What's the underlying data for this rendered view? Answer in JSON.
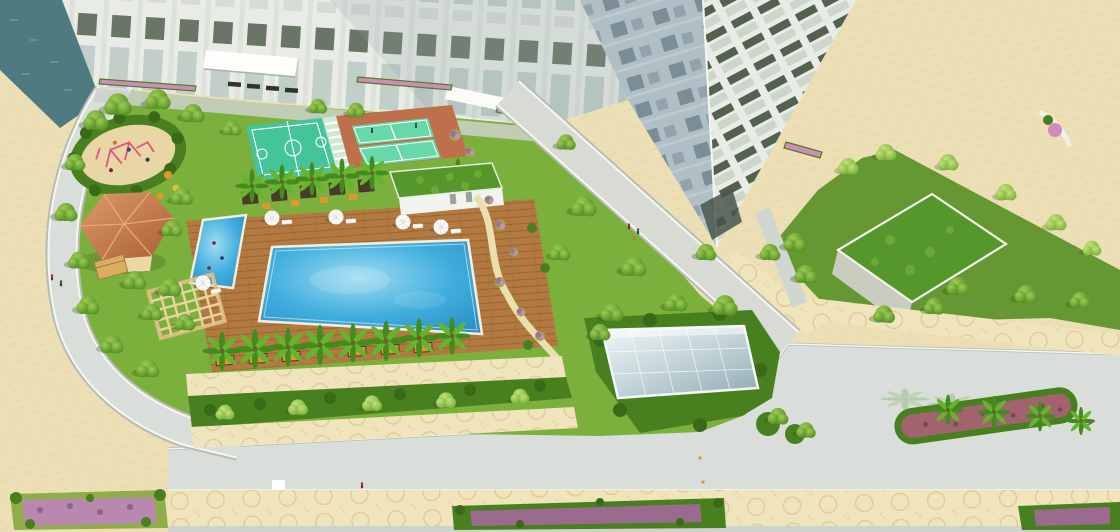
{
  "scene": {
    "type": "aerial-3d-architectural-render-of-residential-complex",
    "elements": {
      "building": "white high-rise tower with podium and entrance canopy",
      "pools": [
        "main swimming pool",
        "children's pool"
      ],
      "courts": [
        "basketball court",
        "badminton courts"
      ],
      "playground": "oval sand playground with pink play equipment",
      "pavilion": "terracotta-roof garden pavilion",
      "pergola": "timber pergola lounge",
      "pool_house": "white pool house with green living roof",
      "glass_canopy": "glass skylight canopy over hedge garden",
      "green_roof_structure": "green-roof garden structure on east lawn",
      "roads": [
        "internal loop road",
        "main boulevard with sidewalks"
      ],
      "median": "palm median island with red groundcover"
    },
    "counts": {
      "pool_umbrellas": 5,
      "poolside_palms": 8,
      "median_palms": 4,
      "court_players": 2,
      "pedestrians_visible": 8
    }
  },
  "palette": {
    "plaza": "#ecdfb6",
    "plaza_motif": "#dccb96",
    "road": "#d9deda",
    "road_dark": "#cdd3cc",
    "curb": "#b7bdb4",
    "road_line": "#f6f7f3",
    "walk": "#f0e4bc",
    "walk_motif": "#d8c38c",
    "lawn": "#7cb03d",
    "lawn_dark": "#659832",
    "hedge": "#49801f",
    "hedge_dark": "#3a6a18",
    "tree_light": "#8cc44a",
    "tree_mid": "#5d9e2a",
    "tree_dark": "#3f7318",
    "palm_leaf": "#3f8d1d",
    "palm_light": "#63b42f",
    "pool": "#41aede",
    "pool_light": "#9fdcf2",
    "pool_deep": "#2b90c4",
    "coping": "#f3eedb",
    "deck": "#b27a41",
    "deck_dark": "#8d5c2b",
    "pergola": "#e8cd96",
    "club_roof": "#cd8052",
    "club_roof_dark": "#a85f33",
    "club_wall": "#ead9a6",
    "sand": "#e9d6a5",
    "play_pink": "#e0557f",
    "court_teal": "#45c39a",
    "court_mint": "#66d8aa",
    "court_apron": "#bf6f4c",
    "court_line": "#ffffff",
    "facade": "#e9ece6",
    "facade_trim": "#dde2da",
    "tower_shadow_face": "#b0bfc6",
    "win_dark": "#53624f",
    "win_gray": "#c2cec8",
    "glass_teal": "#4f7a82",
    "glass_teal_light": "#6d99a1",
    "canopy_hi": "#f2f6f6",
    "canopy_lo": "#8fa9b1",
    "flower_purple": "#a66ba2",
    "flower_pink": "#cf8cba",
    "flower_orange": "#e2952f",
    "median_red": "#a2636e",
    "bench_dark": "#2f342f",
    "white": "#ffffff",
    "person_red": "#8e1f2c",
    "person_dark": "#3a3a42"
  }
}
